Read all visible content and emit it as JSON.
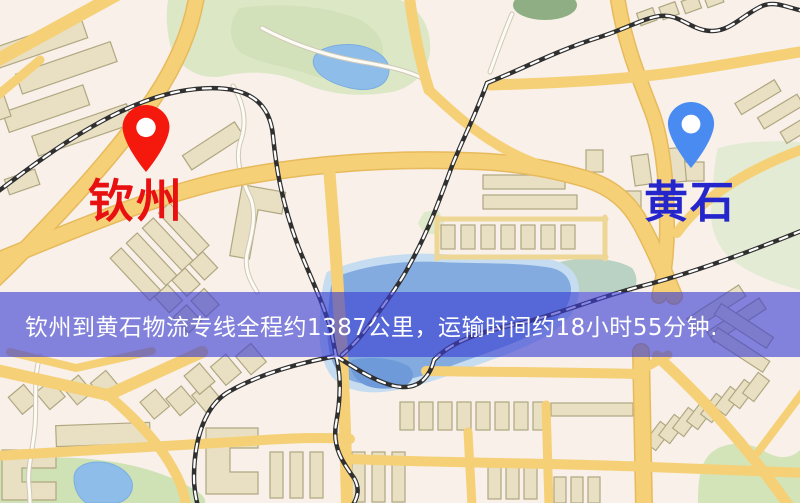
{
  "map": {
    "origin": {
      "label": "钦州",
      "label_color": "#e81010",
      "pin_color": "#f2190d"
    },
    "destination": {
      "label": "黄石",
      "label_color": "#2525cc",
      "pin_color": "#4b8bf0"
    },
    "banner": {
      "text": "钦州到黄石物流专线全程约1387公里，运输时间约18小时55分钟.",
      "background": "rgba(58,62,210,0.62)",
      "text_color": "#ffffff"
    }
  },
  "palette": {
    "map_background": "#f8f0e9",
    "road_fill": "#f4d078",
    "road_casing": "#e6ba5e",
    "building_fill": "#e9e0c4",
    "building_outline": "#b0a782",
    "park_green": "#dce7c6",
    "water_blue": "#8fbde8",
    "railway_dark": "#303030",
    "railway_dash": "#ffffff"
  }
}
